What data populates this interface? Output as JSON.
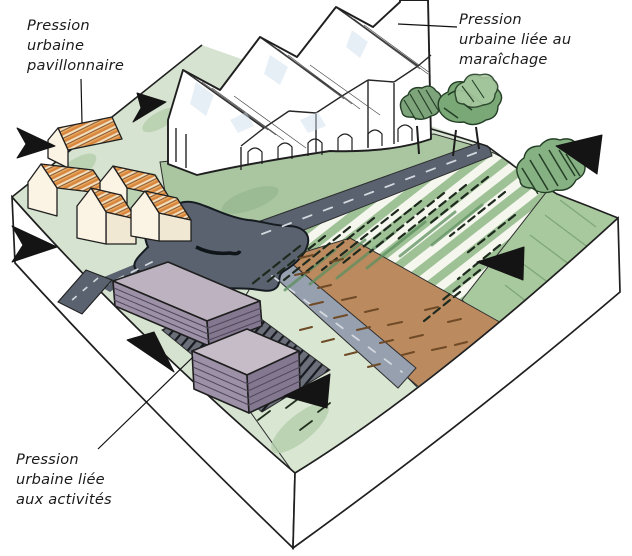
{
  "canvas": {
    "width": 632,
    "height": 556,
    "background": "#ffffff"
  },
  "labels": {
    "pavillonnaire": "Pression\nurbaine\npavillonnaire",
    "maraichage": "Pression\nurbaine liée au\nmaraîchage",
    "activites": "Pression\nurbaine liée\naux activités"
  },
  "arrows": {
    "count": 7,
    "color": "#141414"
  },
  "palette": {
    "ground_base": "#d6e3d0",
    "ground_blotch": "#b5cfac",
    "apron_green": "#a9c6a1",
    "row_white": "#f5f7ef",
    "row_green": "#9fc196",
    "field_margin": "#a8c99e",
    "south_green": "#d8e6d2",
    "road_dark": "#59626e",
    "road_mid": "#97a0ae",
    "road_dash": "#d3d8df",
    "brown_field": "#bc8a5f",
    "building_top": "#bdb3c0",
    "building_top_front": "#c6bcc8",
    "building_front": "#9c91a6",
    "building_side": "#837890",
    "house_wall": "#fbf3e3",
    "house_wall_side": "#f1e8d4",
    "roof_orange": "#d9863d",
    "roof_cream": "#f2e2c4",
    "roof_brown": "#8a5a30",
    "roof_amber": "#e8a55c",
    "greenhouse_white": "#ffffff",
    "glass_blue": "#ccdcec",
    "tree_green": "#7aa877",
    "hedge_green": "#86b183",
    "bush_light": "#a8c9a0",
    "bush_dark": "#7ea47b",
    "arrow_black": "#141414",
    "hatch_bg": "#6b6f79",
    "hatch_line": "#171a20",
    "side_face": "#ffffff"
  }
}
